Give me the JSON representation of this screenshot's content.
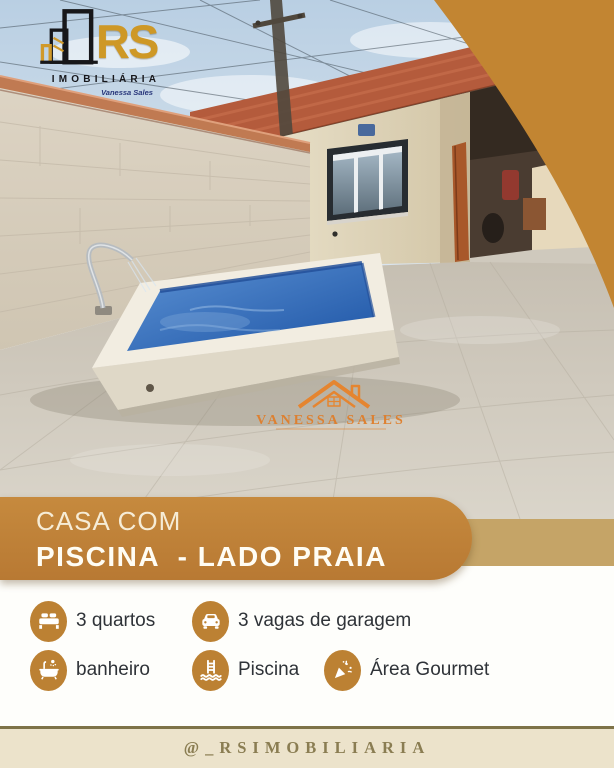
{
  "brand": {
    "logo": {
      "monogram": "RS",
      "word": "IMOBILIÁRIA",
      "signature": "Vanessa Sales",
      "icon": "buildings-outline-icon"
    },
    "watermark": {
      "name": "VANESSA SALES",
      "icon": "house-roof-icon"
    }
  },
  "banner": {
    "line1": "CASA COM",
    "line2": "PISCINA  - LADO PRAIA"
  },
  "features": [
    {
      "icon": "bed-icon",
      "label": "3 quartos"
    },
    {
      "icon": "car-icon",
      "label": "3 vagas de garagem"
    },
    {
      "icon": "bathtub-icon",
      "label": "banheiro"
    },
    {
      "icon": "pool-ladder-icon",
      "label": "Piscina"
    },
    {
      "icon": "party-popper-icon",
      "label": "Área Gourmet"
    }
  ],
  "footer": {
    "handle": "@_RSIMOBILIARIA"
  },
  "photo": {
    "subject": "backyard with blue swimming pool, beige brick wall, new house and tiled patio"
  },
  "colors": {
    "gold_corner": "#C28532",
    "banner_gold": "#BE8038",
    "accent_strip": "#C5A467",
    "icon_gold": "#BC8133",
    "footer_bg": "#ECE3CB",
    "footer_line": "#7E7348",
    "footer_text": "#8A7D52",
    "watermark_orange": "#E4812C",
    "logo_gold": "#CE9826",
    "pool_blue": "#2A5FA8",
    "feature_text": "#2F3338"
  }
}
